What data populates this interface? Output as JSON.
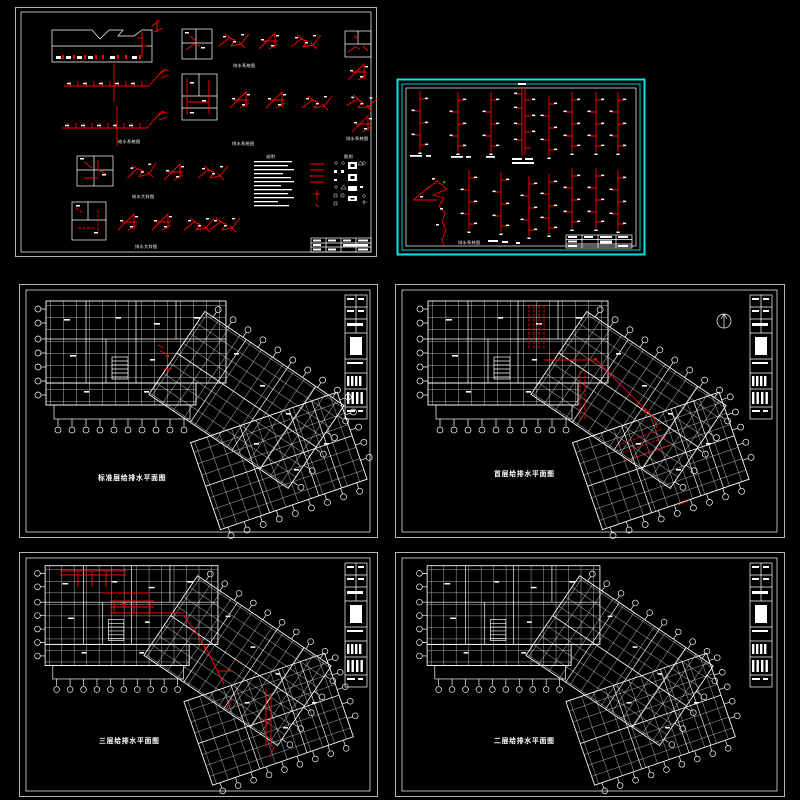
{
  "app": {
    "background": "#000000"
  },
  "colors": {
    "line": "#ffffff",
    "pipe": "#ff0000",
    "frame": "#00e5e5",
    "marker": "#00c000"
  },
  "sheet_details": {
    "captions": [
      "排水系统图",
      "给水系统图",
      "排水系统图",
      "排水系统图",
      "给水大样图",
      "排水大样图"
    ],
    "notes_title": "说明",
    "legend_title": "图例"
  },
  "sheet_risers": {
    "caption": "排水系统图"
  },
  "floor_plans": [
    {
      "id": "standard",
      "title": "标准层给排水平面图"
    },
    {
      "id": "first",
      "title": "首层给排水平面图"
    },
    {
      "id": "third",
      "title": "三层给排水平面图"
    },
    {
      "id": "second",
      "title": "二层给排水平面图"
    }
  ]
}
